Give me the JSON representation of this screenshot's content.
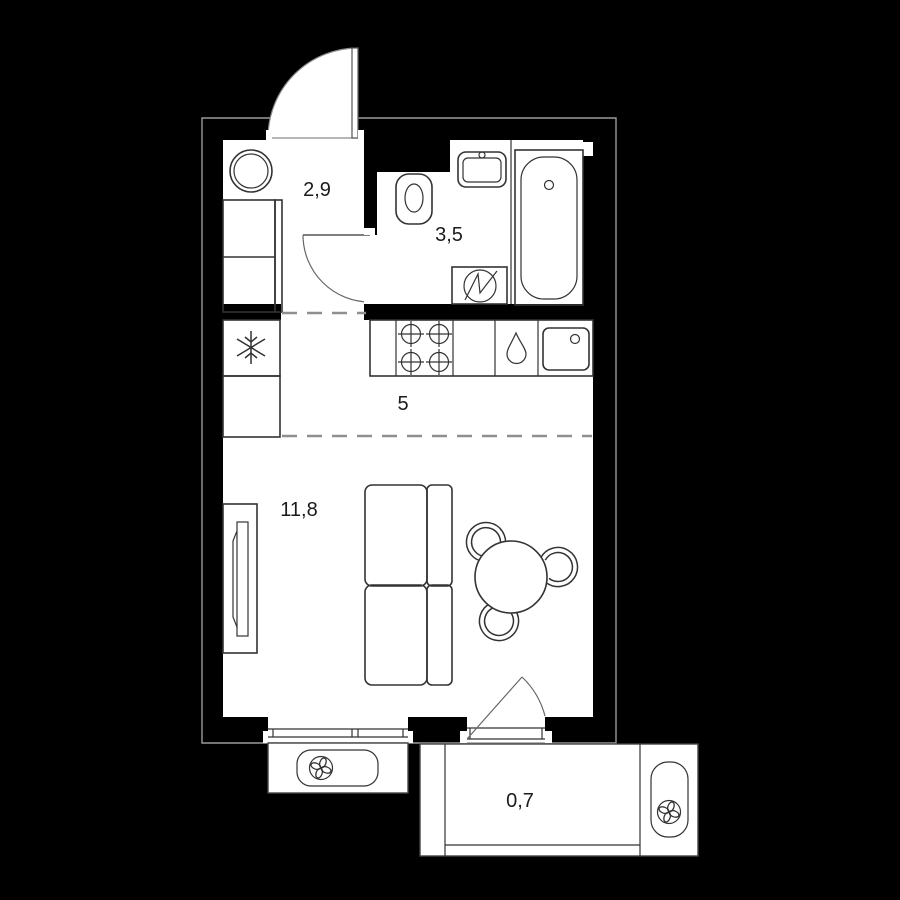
{
  "plan": {
    "title": "Studio apartment floor plan",
    "rooms": [
      {
        "name": "hallway",
        "area": "2,9"
      },
      {
        "name": "bathroom",
        "area": "3,5"
      },
      {
        "name": "kitchen",
        "area": "5"
      },
      {
        "name": "living-room",
        "area": "11,8"
      },
      {
        "name": "balcony",
        "area": "0,7"
      }
    ],
    "icons": {
      "fridge": "snowflake",
      "stove": "four-burners",
      "dishwasher": "water-drop",
      "washing_machine": "circle-zigzag",
      "ac_unit": "fan"
    },
    "colors": {
      "background": "#000000",
      "room_fill": "#ffffff",
      "line": "#333333",
      "outline": "#9b9b9b",
      "label": "#1b1b1b"
    }
  }
}
